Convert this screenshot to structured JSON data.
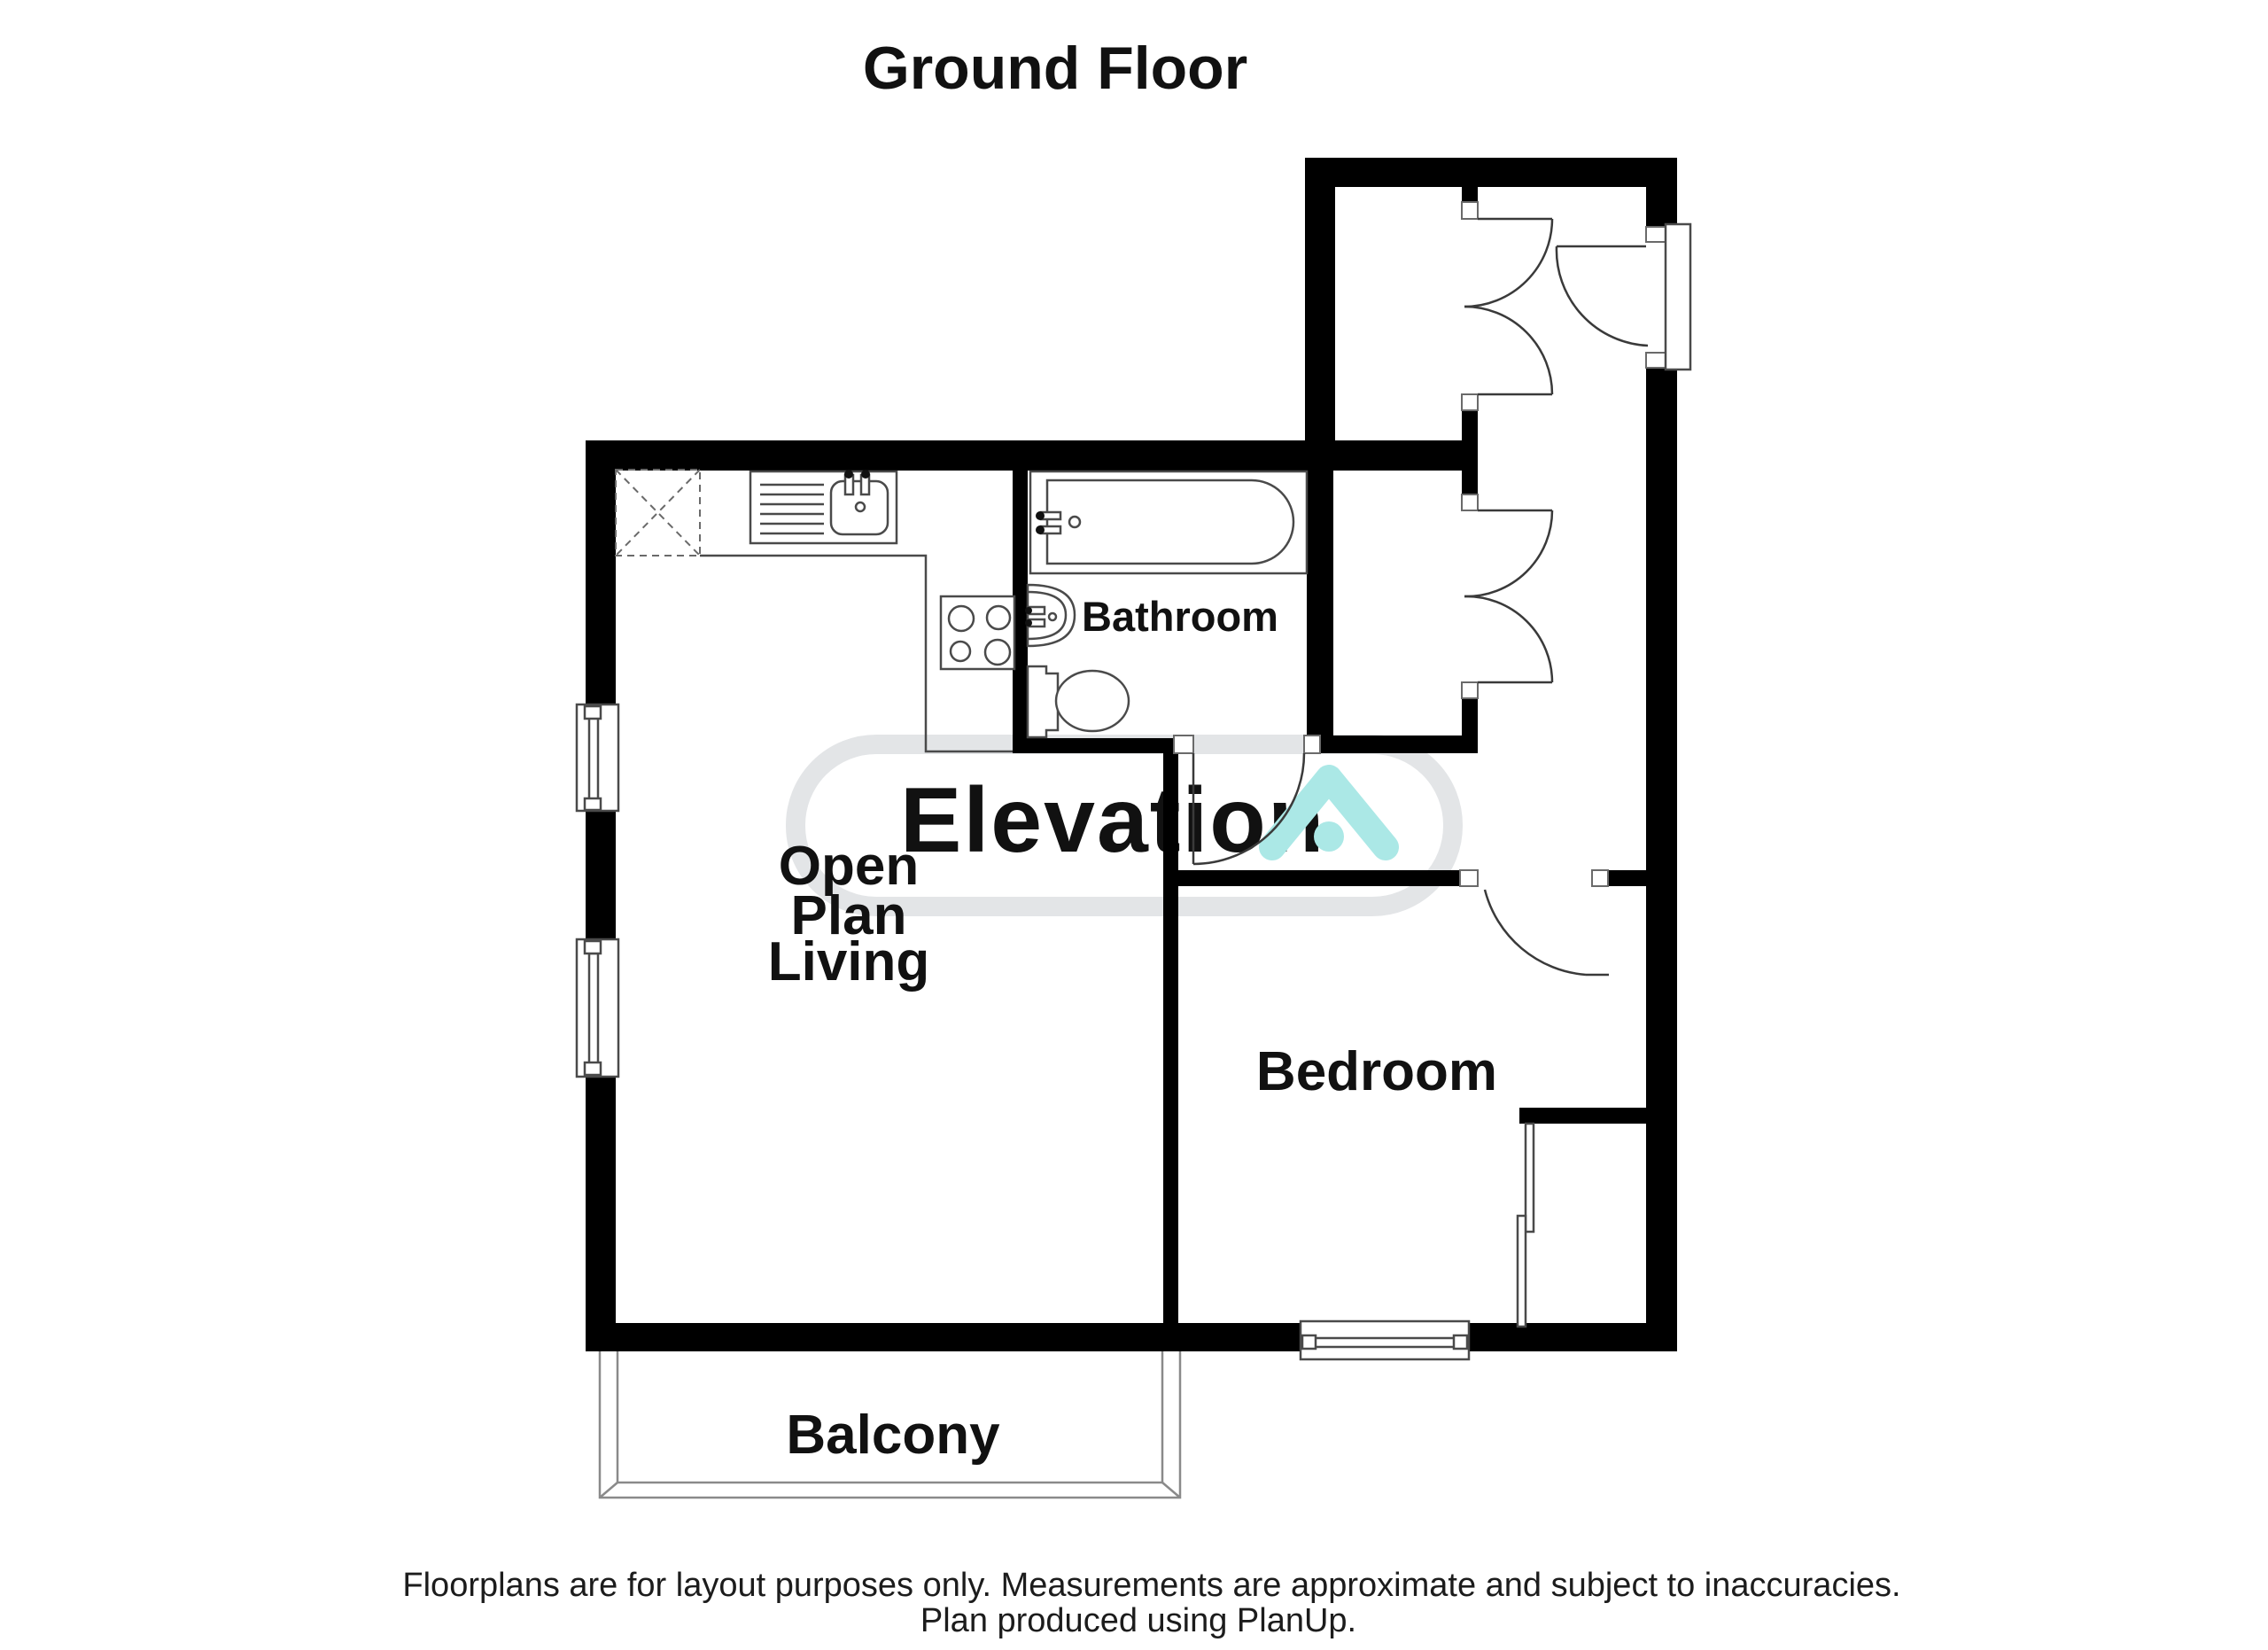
{
  "page": {
    "title": "Ground Floor"
  },
  "rooms": {
    "open_plan_living": {
      "line1": "Open",
      "line2": "Plan",
      "line3": "Living"
    },
    "bathroom": {
      "label": "Bathroom"
    },
    "bedroom": {
      "label": "Bedroom"
    },
    "balcony": {
      "label": "Balcony"
    }
  },
  "watermark": {
    "text": "Elevation",
    "logo": "house-chevron-icon",
    "color_gray": "#e3e5e7",
    "color_teal": "#abe8e6"
  },
  "fixtures": {
    "sink": "kitchen-sink",
    "hob": "four-ring-hob",
    "bath": "bathtub",
    "basin": "wash-basin",
    "toilet": "toilet",
    "wardrobe": "sliding-door-wardrobe"
  },
  "footer": {
    "line1": "Floorplans are for layout purposes only. Measurements are approximate and subject to inaccuracies.",
    "line2": "Plan produced using PlanUp."
  },
  "colors": {
    "wall": "#000000",
    "text": "#111111"
  }
}
